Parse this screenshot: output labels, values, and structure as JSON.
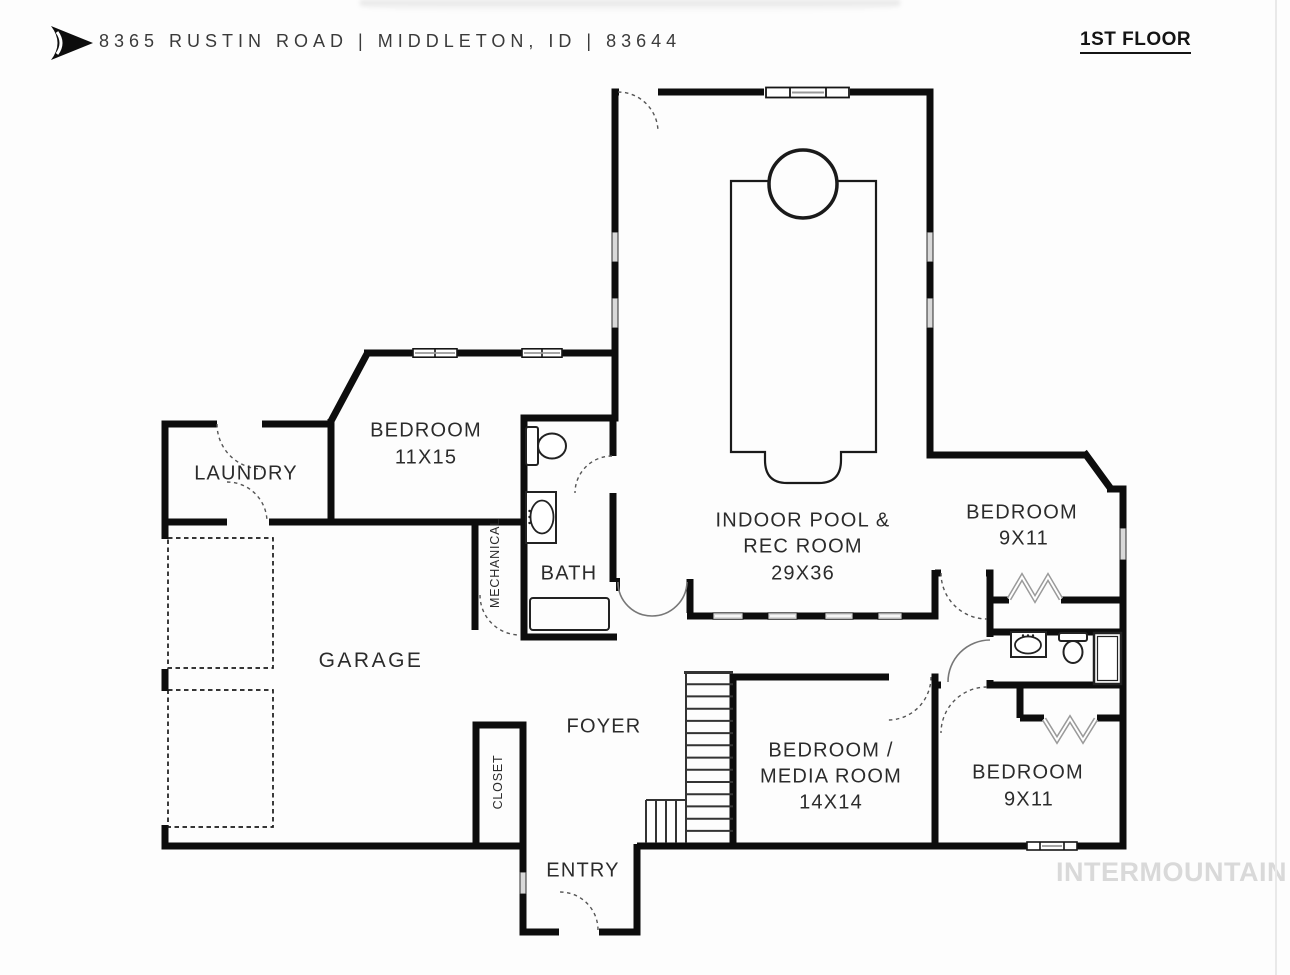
{
  "header": {
    "logo_icon": "arrow-logo",
    "address": "8365 RUSTIN ROAD | MIDDLETON, ID | 83644",
    "floor_label": "1ST FLOOR"
  },
  "watermark": {
    "text": "INTERMOUNTAIN",
    "color": "#d9d9d9"
  },
  "colors": {
    "wall": "#0d0d0d",
    "paper": "#fdfdfd",
    "window_fill": "#d9d9d9",
    "label_text": "#2b2b2b"
  },
  "rooms": {
    "laundry": {
      "label": "LAUNDRY"
    },
    "bedroom_11x15": {
      "label": "BEDROOM",
      "dims": "11X15"
    },
    "bath": {
      "label": "BATH"
    },
    "mechanical": {
      "label": "MECHANICAL"
    },
    "garage": {
      "label": "GARAGE"
    },
    "closet": {
      "label": "CLOSET"
    },
    "foyer": {
      "label": "FOYER"
    },
    "entry": {
      "label": "ENTRY"
    },
    "pool": {
      "line1": "INDOOR POOL &",
      "line2": "REC ROOM",
      "dims": "29X36"
    },
    "media": {
      "line1": "BEDROOM /",
      "line2": "MEDIA ROOM",
      "dims": "14X14"
    },
    "bedroom_9x11_upper": {
      "label": "BEDROOM",
      "dims": "9X11"
    },
    "bedroom_9x11_lower": {
      "label": "BEDROOM",
      "dims": "9X11"
    }
  }
}
